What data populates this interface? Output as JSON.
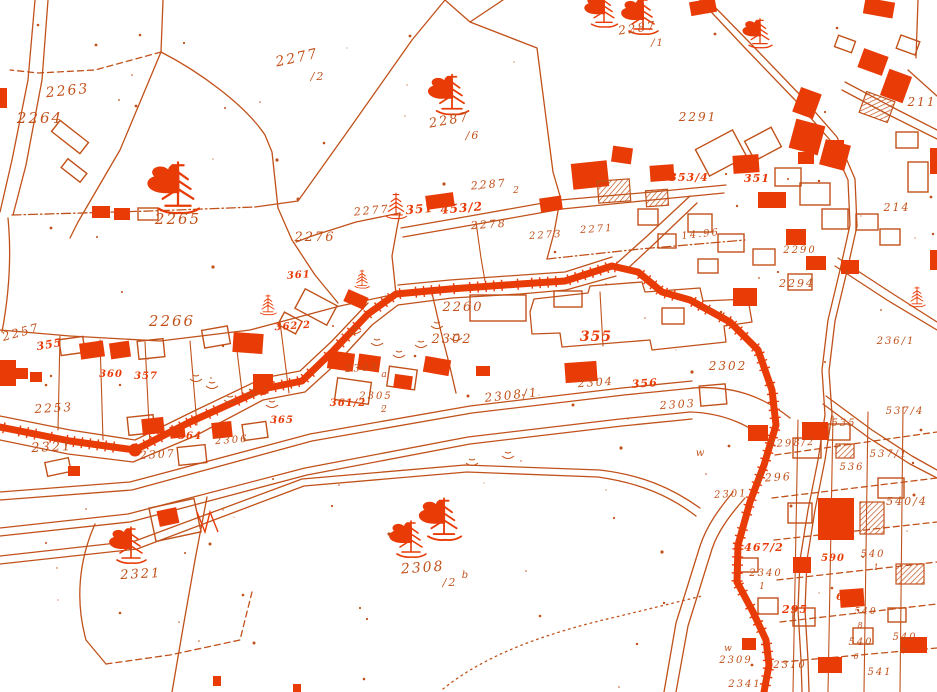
{
  "map": {
    "colors": {
      "paper": "#ffffff",
      "ink": "#c1511a",
      "highlight": "#e83b06"
    },
    "labels": [
      {
        "text": "2263",
        "x": 68,
        "y": 95,
        "size": 14,
        "rot": -6
      },
      {
        "text": "2264",
        "x": 40,
        "y": 123,
        "size": 15,
        "rot": 0
      },
      {
        "text": "2277",
        "x": 298,
        "y": 62,
        "size": 14,
        "rot": -12
      },
      {
        "text": "/2",
        "x": 318,
        "y": 80,
        "size": 11,
        "rot": 0
      },
      {
        "text": "2265",
        "x": 178,
        "y": 224,
        "size": 15,
        "rot": 0
      },
      {
        "text": "2287",
        "x": 450,
        "y": 124,
        "size": 13,
        "rot": -10
      },
      {
        "text": "/6",
        "x": 473,
        "y": 139,
        "size": 11,
        "rot": 0
      },
      {
        "text": "2287",
        "x": 638,
        "y": 32,
        "size": 12,
        "rot": -8
      },
      {
        "text": "/1",
        "x": 658,
        "y": 46,
        "size": 10,
        "rot": 0
      },
      {
        "text": "2291",
        "x": 698,
        "y": 121,
        "size": 12,
        "rot": 0
      },
      {
        "text": "2287",
        "x": 489,
        "y": 188,
        "size": 11,
        "rot": -5
      },
      {
        "text": "2",
        "x": 517,
        "y": 193,
        "size": 9,
        "rot": 0
      },
      {
        "text": "453/2",
        "x": 462,
        "y": 212,
        "size": 12,
        "rot": -5,
        "cls": "solid"
      },
      {
        "text": "2278",
        "x": 489,
        "y": 228,
        "size": 11,
        "rot": -4
      },
      {
        "text": "2277",
        "x": 372,
        "y": 214,
        "size": 11,
        "rot": -5
      },
      {
        "text": "2276",
        "x": 315,
        "y": 241,
        "size": 13,
        "rot": 0
      },
      {
        "text": "2273",
        "x": 546,
        "y": 238,
        "size": 10,
        "rot": -4
      },
      {
        "text": "2271",
        "x": 597,
        "y": 232,
        "size": 10,
        "rot": -4
      },
      {
        "text": "14.96",
        "x": 701,
        "y": 237,
        "size": 10,
        "rot": -6
      },
      {
        "text": "351",
        "x": 420,
        "y": 213,
        "size": 12,
        "rot": -5,
        "cls": "solid"
      },
      {
        "text": "353/4",
        "x": 689,
        "y": 181,
        "size": 11,
        "rot": 0,
        "cls": "solid"
      },
      {
        "text": "351",
        "x": 757,
        "y": 182,
        "size": 11,
        "rot": 0,
        "cls": "solid"
      },
      {
        "text": "211",
        "x": 922,
        "y": 106,
        "size": 12,
        "rot": 0
      },
      {
        "text": "214",
        "x": 897,
        "y": 211,
        "size": 11,
        "rot": 0
      },
      {
        "text": "2290",
        "x": 800,
        "y": 253,
        "size": 10,
        "rot": 0
      },
      {
        "text": "2294",
        "x": 797,
        "y": 287,
        "size": 11,
        "rot": 0
      },
      {
        "text": "2260",
        "x": 463,
        "y": 311,
        "size": 13,
        "rot": 0
      },
      {
        "text": "361",
        "x": 299,
        "y": 278,
        "size": 10,
        "rot": -4,
        "cls": "solid"
      },
      {
        "text": "362/2",
        "x": 293,
        "y": 329,
        "size": 10,
        "rot": -4,
        "cls": "solid"
      },
      {
        "text": "2266",
        "x": 172,
        "y": 326,
        "size": 15,
        "rot": 0
      },
      {
        "text": "2257",
        "x": 22,
        "y": 336,
        "size": 12,
        "rot": -15
      },
      {
        "text": "355",
        "x": 50,
        "y": 348,
        "size": 11,
        "rot": -10,
        "cls": "solid"
      },
      {
        "text": "2253",
        "x": 54,
        "y": 412,
        "size": 12,
        "rot": -3
      },
      {
        "text": "2321",
        "x": 52,
        "y": 451,
        "size": 13,
        "rot": -3
      },
      {
        "text": "360",
        "x": 111,
        "y": 377,
        "size": 10,
        "rot": 0,
        "cls": "solid"
      },
      {
        "text": "357",
        "x": 146,
        "y": 379,
        "size": 10,
        "rot": 0,
        "cls": "solid"
      },
      {
        "text": "2302",
        "x": 452,
        "y": 343,
        "size": 13,
        "rot": 0
      },
      {
        "text": "355",
        "x": 596,
        "y": 341,
        "size": 14,
        "rot": 0,
        "cls": "solid"
      },
      {
        "text": "2304",
        "x": 596,
        "y": 386,
        "size": 11,
        "rot": -4
      },
      {
        "text": "356",
        "x": 645,
        "y": 387,
        "size": 11,
        "rot": -4,
        "cls": "solid"
      },
      {
        "text": "2303",
        "x": 678,
        "y": 408,
        "size": 11,
        "rot": -4
      },
      {
        "text": "2302",
        "x": 728,
        "y": 370,
        "size": 12,
        "rot": 0
      },
      {
        "text": "2308/1",
        "x": 512,
        "y": 399,
        "size": 12,
        "rot": -6
      },
      {
        "text": "2303",
        "x": 362,
        "y": 371,
        "size": 10,
        "rot": -4
      },
      {
        "text": "a",
        "x": 385,
        "y": 377,
        "size": 9,
        "rot": 0
      },
      {
        "text": "2305",
        "x": 376,
        "y": 399,
        "size": 10,
        "rot": 0
      },
      {
        "text": "2",
        "x": 385,
        "y": 412,
        "size": 9,
        "rot": 0
      },
      {
        "text": "361/2",
        "x": 348,
        "y": 406,
        "size": 10,
        "rot": 0,
        "cls": "solid"
      },
      {
        "text": "2306",
        "x": 232,
        "y": 443,
        "size": 10,
        "rot": -4
      },
      {
        "text": "2307",
        "x": 158,
        "y": 458,
        "size": 11,
        "rot": -3
      },
      {
        "text": "364",
        "x": 190,
        "y": 439,
        "size": 10,
        "rot": 0,
        "cls": "solid"
      },
      {
        "text": "365",
        "x": 282,
        "y": 423,
        "size": 10,
        "rot": 0,
        "cls": "solid"
      },
      {
        "text": "2308",
        "x": 423,
        "y": 572,
        "size": 14,
        "rot": -4
      },
      {
        "text": "/2",
        "x": 450,
        "y": 586,
        "size": 11,
        "rot": 0
      },
      {
        "text": "b",
        "x": 466,
        "y": 578,
        "size": 10,
        "rot": 0
      },
      {
        "text": "2321",
        "x": 141,
        "y": 578,
        "size": 13,
        "rot": -3
      },
      {
        "text": "w",
        "x": 701,
        "y": 456,
        "size": 10,
        "rot": 0
      },
      {
        "text": "w",
        "x": 729,
        "y": 651,
        "size": 9,
        "rot": 0
      },
      {
        "text": "2296",
        "x": 774,
        "y": 481,
        "size": 11,
        "rot": -3
      },
      {
        "text": "2298/2",
        "x": 792,
        "y": 446,
        "size": 10,
        "rot": -3
      },
      {
        "text": "2301",
        "x": 731,
        "y": 497,
        "size": 10,
        "rot": -3
      },
      {
        "text": "467/2",
        "x": 764,
        "y": 551,
        "size": 11,
        "rot": 0,
        "cls": "solid"
      },
      {
        "text": "2340",
        "x": 766,
        "y": 576,
        "size": 10,
        "rot": 0
      },
      {
        "text": "1",
        "x": 763,
        "y": 589,
        "size": 9,
        "rot": 0
      },
      {
        "text": "295",
        "x": 795,
        "y": 613,
        "size": 11,
        "rot": 0,
        "cls": "solid"
      },
      {
        "text": "2309",
        "x": 736,
        "y": 663,
        "size": 10,
        "rot": 0
      },
      {
        "text": "2310",
        "x": 790,
        "y": 668,
        "size": 10,
        "rot": 0
      },
      {
        "text": "2341",
        "x": 745,
        "y": 687,
        "size": 10,
        "rot": 0
      },
      {
        "text": "535",
        "x": 844,
        "y": 426,
        "size": 10,
        "rot": 0
      },
      {
        "text": "537/1",
        "x": 889,
        "y": 457,
        "size": 10,
        "rot": 0
      },
      {
        "text": "536",
        "x": 852,
        "y": 470,
        "size": 10,
        "rot": 0
      },
      {
        "text": "540/4",
        "x": 907,
        "y": 505,
        "size": 11,
        "rot": 0
      },
      {
        "text": "590",
        "x": 833,
        "y": 561,
        "size": 10,
        "rot": 0,
        "cls": "solid"
      },
      {
        "text": "540",
        "x": 873,
        "y": 557,
        "size": 10,
        "rot": 0
      },
      {
        "text": "1",
        "x": 877,
        "y": 570,
        "size": 8,
        "rot": 0
      },
      {
        "text": "540",
        "x": 866,
        "y": 614,
        "size": 9,
        "rot": 0
      },
      {
        "text": "8",
        "x": 861,
        "y": 628,
        "size": 8,
        "rot": 0
      },
      {
        "text": "642",
        "x": 848,
        "y": 600,
        "size": 10,
        "rot": 0,
        "cls": "solid"
      },
      {
        "text": "540",
        "x": 861,
        "y": 645,
        "size": 10,
        "rot": 0
      },
      {
        "text": "6",
        "x": 857,
        "y": 659,
        "size": 8,
        "rot": 0
      },
      {
        "text": "540",
        "x": 905,
        "y": 640,
        "size": 10,
        "rot": 0
      },
      {
        "text": "7",
        "x": 905,
        "y": 654,
        "size": 8,
        "rot": 0
      },
      {
        "text": "541",
        "x": 880,
        "y": 675,
        "size": 10,
        "rot": 0
      },
      {
        "text": "236/1",
        "x": 896,
        "y": 344,
        "size": 10,
        "rot": 0
      },
      {
        "text": "537/4",
        "x": 905,
        "y": 414,
        "size": 10,
        "rot": 0
      }
    ],
    "tree_symbols": [
      {
        "x": 178,
        "y": 196,
        "scale": 1.4,
        "swash": true
      },
      {
        "x": 452,
        "y": 101,
        "scale": 1.1,
        "swash": true
      },
      {
        "x": 396,
        "y": 210,
        "scale": 0.7,
        "swash": false
      },
      {
        "x": 268,
        "y": 308,
        "scale": 0.55,
        "swash": false
      },
      {
        "x": 362,
        "y": 282,
        "scale": 0.5,
        "swash": false
      },
      {
        "x": 131,
        "y": 551,
        "scale": 1.0,
        "swash": true
      },
      {
        "x": 411,
        "y": 545,
        "scale": 1.0,
        "swash": true
      },
      {
        "x": 444,
        "y": 526,
        "scale": 1.15,
        "swash": true
      },
      {
        "x": 604,
        "y": 16,
        "scale": 0.9,
        "swash": true
      },
      {
        "x": 643,
        "y": 22,
        "scale": 1.0,
        "swash": true
      },
      {
        "x": 917,
        "y": 300,
        "scale": 0.55,
        "swash": false
      },
      {
        "x": 760,
        "y": 38,
        "scale": 0.8,
        "swash": true
      }
    ],
    "swamp_marks": [
      {
        "x": 212,
        "y": 386
      },
      {
        "x": 230,
        "y": 400
      },
      {
        "x": 196,
        "y": 379
      },
      {
        "x": 252,
        "y": 393
      },
      {
        "x": 272,
        "y": 405
      },
      {
        "x": 355,
        "y": 331
      },
      {
        "x": 377,
        "y": 343
      },
      {
        "x": 399,
        "y": 355
      },
      {
        "x": 421,
        "y": 345
      },
      {
        "x": 437,
        "y": 326
      },
      {
        "x": 456,
        "y": 338
      },
      {
        "x": 508,
        "y": 456
      },
      {
        "x": 472,
        "y": 463
      }
    ]
  }
}
